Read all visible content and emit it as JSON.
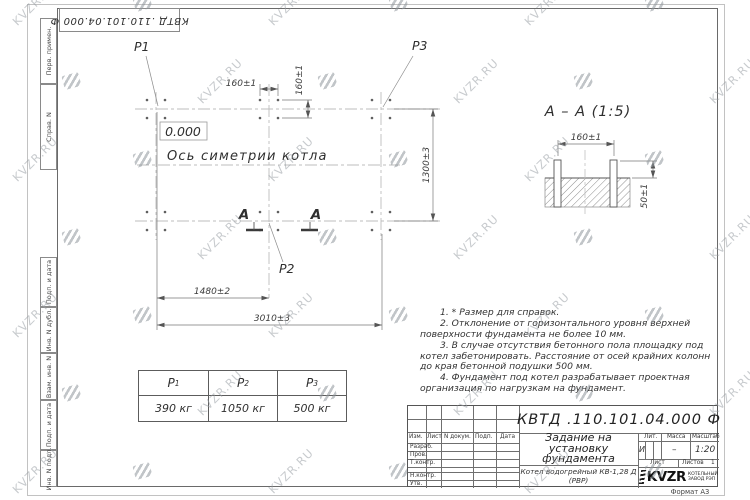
{
  "page": {
    "watermark_text": "KVZR.RU",
    "format_label": "Формат А3"
  },
  "margin_labels": {
    "perv": "Перв. примен.",
    "sprav": "Справ. N",
    "podp1": "Подп. и дата",
    "inv_dubl": "Инв. N дубл.",
    "vzam": "Взам. инв. N",
    "podp2": "Подп. и дата",
    "inv_podl": "Инв. N подл."
  },
  "plan": {
    "label_p1": "P1",
    "label_p2": "P2",
    "label_p3": "P3",
    "elevation": "0.000",
    "axis_label": "Ось симетрии котла",
    "dim_pitch_h": "160±1",
    "dim_pitch_v": "160±1",
    "dim_height": "1300±3",
    "dim_center": "1480±2",
    "dim_length": "3010±3",
    "section_mark": "А"
  },
  "section": {
    "title": "А – А (1:5)",
    "dim_pitch": "160±1",
    "dim_protrusion": "50±1"
  },
  "notes": [
    "1. * Размер для справок.",
    "2. Отклонение от горизонтального уровня верхней поверхности фундамента не более 10 мм.",
    "3. В случае отсутствия бетонного пола площадку под котел забетонировать. Расстояние от осей крайних колонн до края бетонной подушки 500 мм.",
    "4. Фундамент под котел разрабатывает проектная организация по нагрузкам на фундамент."
  ],
  "load_table": {
    "columns": [
      {
        "name": "P",
        "sub": "1",
        "value": "390 кг"
      },
      {
        "name": "P",
        "sub": "2",
        "value": "1050 кг"
      },
      {
        "name": "P",
        "sub": "3",
        "value": "500 кг"
      }
    ]
  },
  "title_block": {
    "doc_number": "КВТД .110.101.04.000  Ф",
    "doc_title": "Задание на установку фундамента",
    "product": "Котел водогрейный КВ-1,28 Д (РВР)",
    "sign_header": [
      "Изм.",
      "Лист",
      "N докум.",
      "Подп.",
      "Дата"
    ],
    "sign_rows": [
      "Разраб.",
      "Пров.",
      "Т.контр.",
      "Н.контр.",
      "Утв."
    ],
    "lit_header": "Лит.",
    "mass_header": "Масса",
    "scale_header": "Масштаб",
    "lit_value": "И",
    "mass_value": "–",
    "scale_value": "1:20",
    "sheet_label": "Лист",
    "sheets_label": "Листов",
    "sheets_value": "1",
    "logo_name": "KVZR",
    "logo_line1": "КОТЕЛЬНЫЙ",
    "logo_line2": "ЗАВОД РЭП"
  }
}
